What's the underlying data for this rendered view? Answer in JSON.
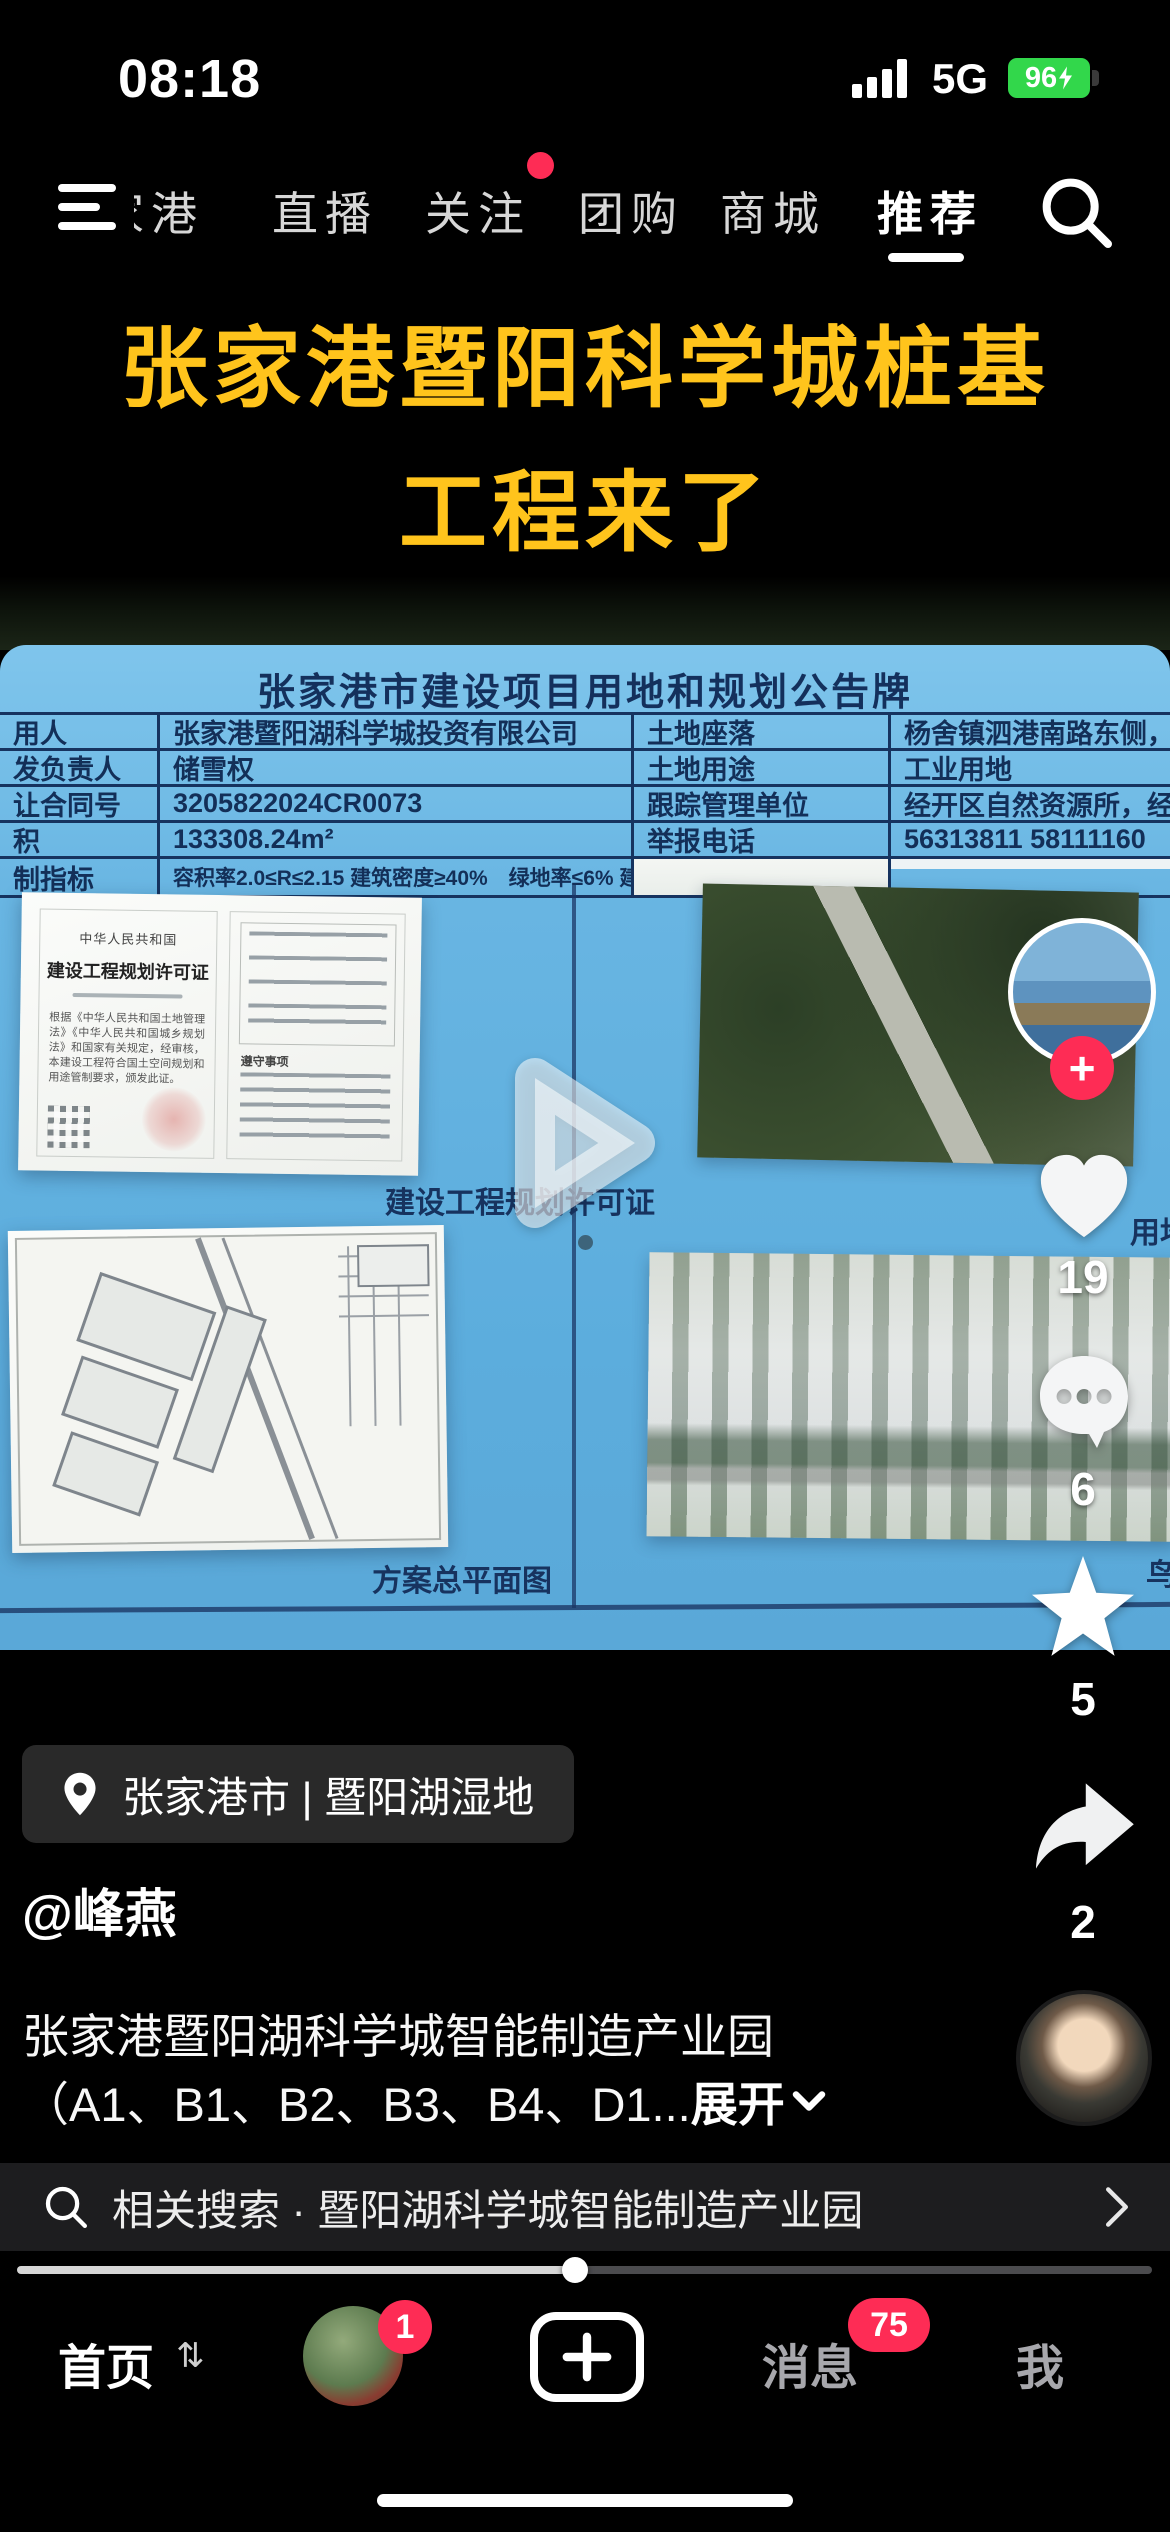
{
  "status_bar": {
    "time": "08:18",
    "network": "5G",
    "battery_percent": "96"
  },
  "top_nav": {
    "tabs": [
      {
        "label": "家港"
      },
      {
        "label": "直播"
      },
      {
        "label": "关注",
        "notification_dot": true
      },
      {
        "label": "团购"
      },
      {
        "label": "商城"
      },
      {
        "label": "推荐",
        "active": true
      }
    ]
  },
  "video": {
    "overlay_title_line1": "张家港暨阳科学城桩基",
    "overlay_title_line2": "工程来了",
    "board": {
      "title": "张家港市建设项目用地和规划公告牌",
      "rows": [
        {
          "l1": "用人",
          "v1": "张家港暨阳湖科学城投资有限公司",
          "l2": "土地座落",
          "v2": "杨舍镇泗港南路东侧，西湖苑"
        },
        {
          "l1": "发负责人",
          "v1": "储雪权",
          "l2": "土地用途",
          "v2": "工业用地"
        },
        {
          "l1": "让合同号",
          "v1": "3205822024CR0073",
          "l2": "跟踪管理单位",
          "v2": "经开区自然资源所，经开区"
        },
        {
          "l1": "积",
          "v1": "133308.24m²",
          "l2": "举报电话",
          "v2": "56313811  58111160"
        },
        {
          "l1": "制指标",
          "v1": "容积率2.0≤R≤2.15 建筑密度≥40%　绿地率≤6% 建筑限高≥10米",
          "l2": "",
          "v2": ""
        }
      ],
      "permit": {
        "country": "中华人民共和国",
        "title": "建设工程规划许可证",
        "body": "根据《中华人民共和国土地管理法》《中华人民共和国城乡规划法》和国家有关规定，经审核，本建设工程符合国土空间规划和用途管制要求，颁发此证。",
        "notice_title": "遵守事项"
      },
      "captions": {
        "permit": "建设工程规划许可证",
        "siteplan": "方案总平面图",
        "satellite_partial": "用地",
        "render_partial": "鸟"
      }
    }
  },
  "engagement": {
    "likes": "19",
    "comments": "6",
    "favorites": "5",
    "shares": "2"
  },
  "info": {
    "location": "张家港市 | 暨阳湖湿地",
    "username": "@峰燕",
    "desc_line1": "张家港暨阳湖科学城智能制造产业园",
    "desc_line2": "（A1、B1、B2、B3、B4、D1...",
    "expand_label": "展开"
  },
  "search": {
    "label": "相关搜索 · 暨阳湖科学城智能制造产业园"
  },
  "bottom_nav": {
    "home": "首页",
    "messages": "消息",
    "me": "我",
    "avatar_badge": "1",
    "messages_badge": "75"
  },
  "colors": {
    "accent_red": "#FE2C55",
    "battery_green": "#32D74B",
    "board_blue": "#63B1E0",
    "title_yellow": "#FFC41C"
  }
}
